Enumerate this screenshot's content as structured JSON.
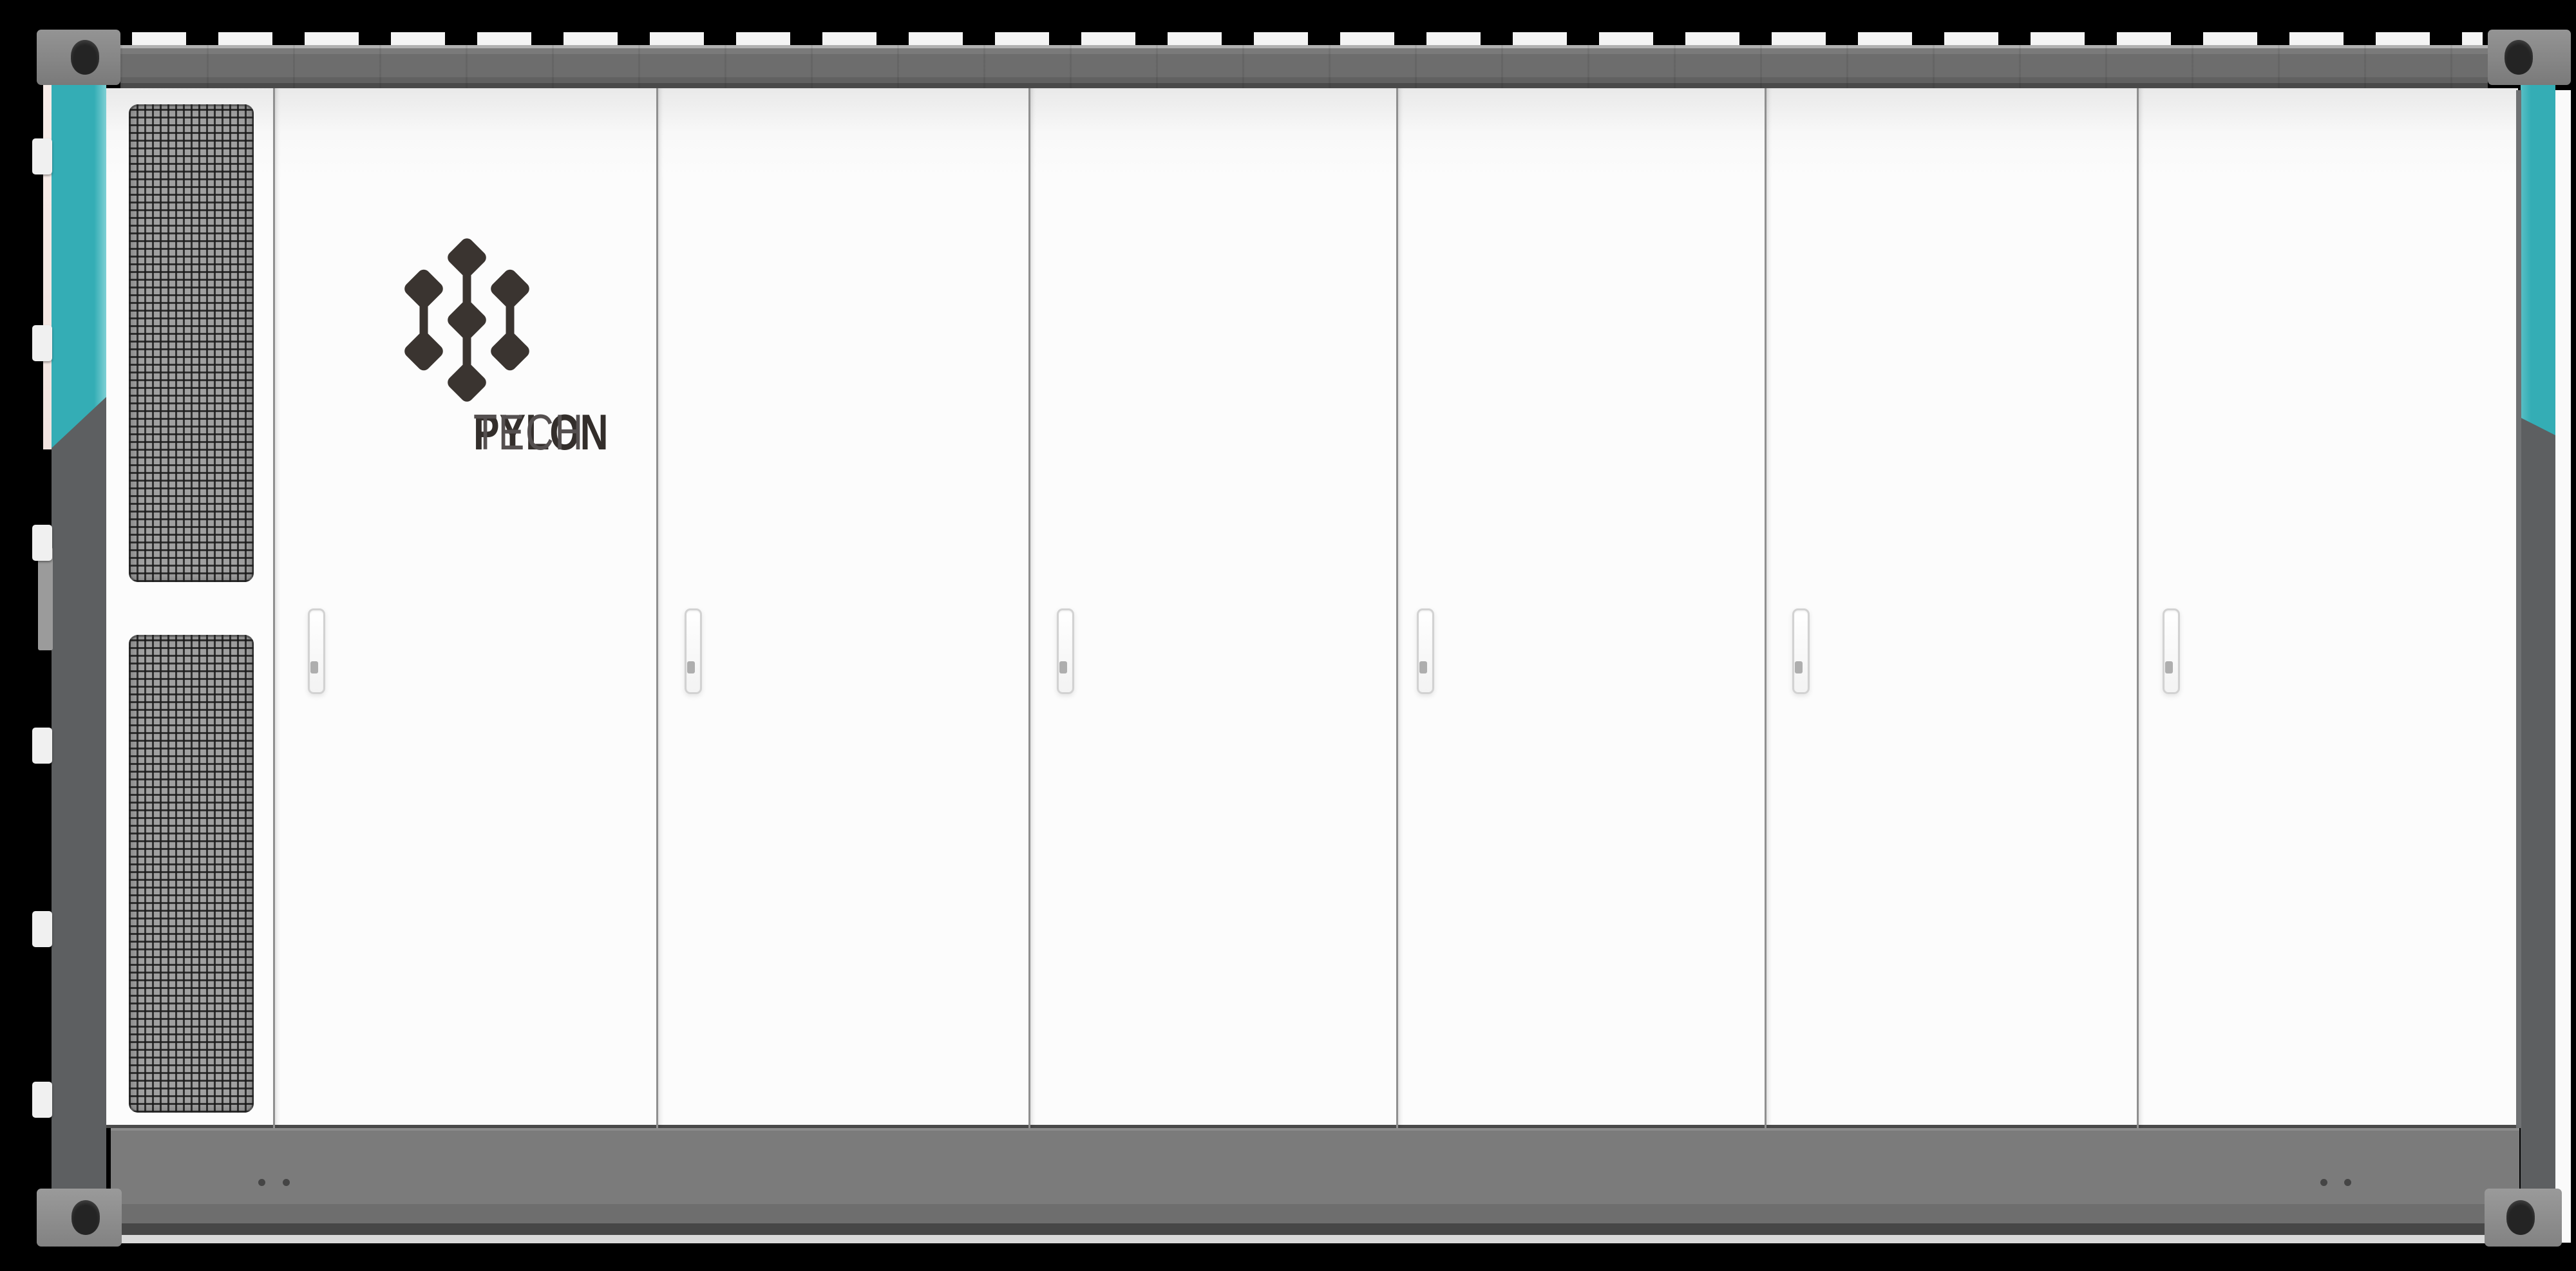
{
  "brand": {
    "wordmark_bold": "PYLON",
    "wordmark_light": "TECH",
    "logo_icon": "pylontech-diamonds-logo"
  },
  "container": {
    "door_count": 6,
    "handle_count": 6,
    "vent_grille_count": 2,
    "hinge_tab_count": 6,
    "corner_casting_count": 4,
    "rivet_dot_count": 4,
    "roof_dash_row": true
  },
  "colors": {
    "background": "#000000",
    "accent_teal": "#34adb5",
    "top_rail_gray": "#6d6d6d",
    "bottom_rail_gray": "#7b7b7b",
    "corner_post_gray": "#5d5f61",
    "casting_gray": "#878787",
    "casting_hole": "#242424",
    "door_white": "#fcfcfc",
    "door_separator": "#8f8f8f",
    "grille_mesh": "#676767",
    "logo_dark": "#332e2b",
    "logo_light_text": "#555050"
  }
}
